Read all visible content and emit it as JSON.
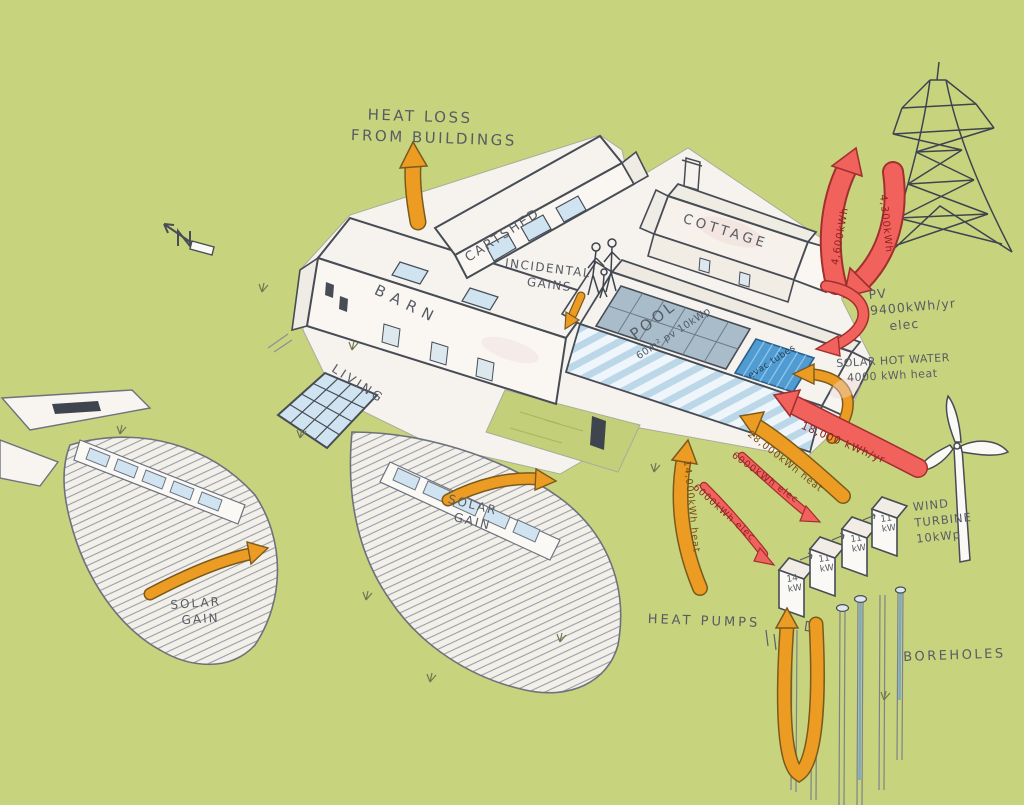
{
  "title": "Hand-drawn building energy strategy sketch",
  "colors": {
    "background": "#c8d37e",
    "arrow_orange": "#ec9c22",
    "arrow_red": "#f2625c",
    "ink": "#474c55",
    "pv_panel": "#a9bcc9",
    "evac_blue": "#4f9bd2",
    "glazing": "#cfe4f0"
  },
  "labels": {
    "heat_loss_1": "HEAT LOSS",
    "heat_loss_2": "FROM BUILDINGS",
    "barn": "BARN",
    "cartshed": "CARTSHED",
    "cottage": "COTTAGE",
    "incidental_1": "INCIDENTAL",
    "incidental_2": "GAINS",
    "pool": "POOL",
    "pv_roof": "60m² pv 10kWp",
    "evac_tubes": "evac tubes",
    "living": "LIVING",
    "solar_gain_a1": "SOLAR",
    "solar_gain_a2": "GAIN",
    "solar_gain_b1": "SOLAR",
    "solar_gain_b2": "GAIN",
    "pv_1": "PV",
    "pv_2": "9400kWh/yr",
    "pv_3": "elec",
    "shw_1": "SOLAR HOT WATER",
    "shw_2": "4000 kWh heat",
    "wind_1": "WIND",
    "wind_2": "TURBINE",
    "wind_3": "10kWp",
    "heat_pumps": "HEAT PUMPS",
    "boreholes": "BOREHOLES"
  },
  "flows": {
    "grid_export": "4,600kWh",
    "grid_import": "4,300kWh",
    "wind_elec": "18,000 kWh/yr",
    "heat_to_pool": "28,000kWh heat",
    "heat_to_buildings": "14,000kWh heat",
    "hp_elec_1": "6000kWh elec",
    "hp_elec_2": "6000kWh elec"
  },
  "heat_pump_units": [
    {
      "power": "14",
      "unit": "kW"
    },
    {
      "power": "11",
      "unit": "kW"
    },
    {
      "power": "11",
      "unit": "kW"
    },
    {
      "power": "11",
      "unit": "kW"
    }
  ]
}
